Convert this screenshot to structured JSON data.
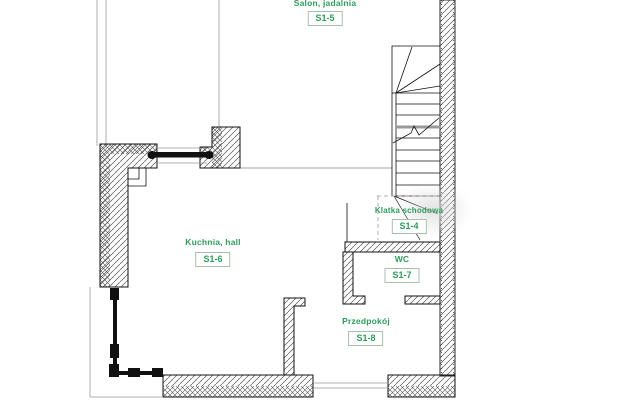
{
  "colors": {
    "label_green": "#2f9c5c",
    "box_border": "#a9bfae",
    "wall_line": "#111111",
    "hatch": "#555555",
    "thin_gray": "#999999",
    "watermark_gray": "#d9d9d9",
    "background": "#ffffff"
  },
  "rooms": [
    {
      "name": "Salon, jadalnia",
      "code": "S1-5"
    },
    {
      "name": "Kuchnia,  hall",
      "code": "S1-6"
    },
    {
      "name": "Klatka schodowa",
      "code": "S1-4"
    },
    {
      "name": "WC",
      "code": "S1-7"
    },
    {
      "name": "Przedpokój",
      "code": "S1-8"
    }
  ]
}
